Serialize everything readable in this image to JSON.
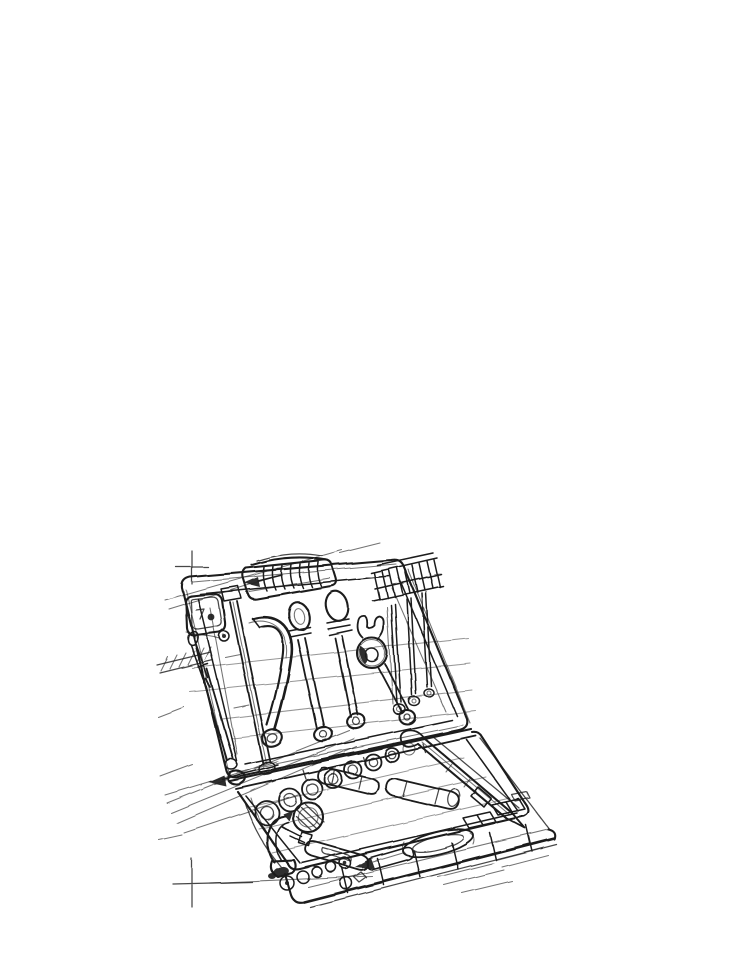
{
  "artwork": {
    "title": "Freehand pen-and-ink sketch of an open toolbox filled with tools",
    "style": "scratchy concept-drawing line work with construction guides",
    "background_color": "#ffffff",
    "ink_color": "#1b1b1b",
    "canvas": {
      "width": 732,
      "height": 941
    },
    "subject": {
      "description": "An open hard-shell tool case drawn in perspective. The raised lid holds molded-in tools; the lower tray holds loose tools and sockets.",
      "lid_items": [
        "tape measure",
        "ribbed carry handle with direction arrow",
        "flat pry bar",
        "curved saw-handle tool",
        "two screwdrivers with oval grips",
        "combination wrench",
        "three precision drivers",
        "hex-key comb with hatching",
        "small driver",
        "long rod"
      ],
      "base_items": [
        "row of seven sockets",
        "knurled round knob",
        "two driver cylinders",
        "ratchet screwdriver",
        "claw hammer",
        "loose bits and balls",
        "chisel bit",
        "hooked pry bar",
        "oval tray",
        "divided front compartments"
      ],
      "annotations": [
        "registration crosshair top-left",
        "registration crosshair bottom-left",
        "diagonal construction guide lines",
        "hinge line with left-pointing arrow"
      ]
    }
  }
}
